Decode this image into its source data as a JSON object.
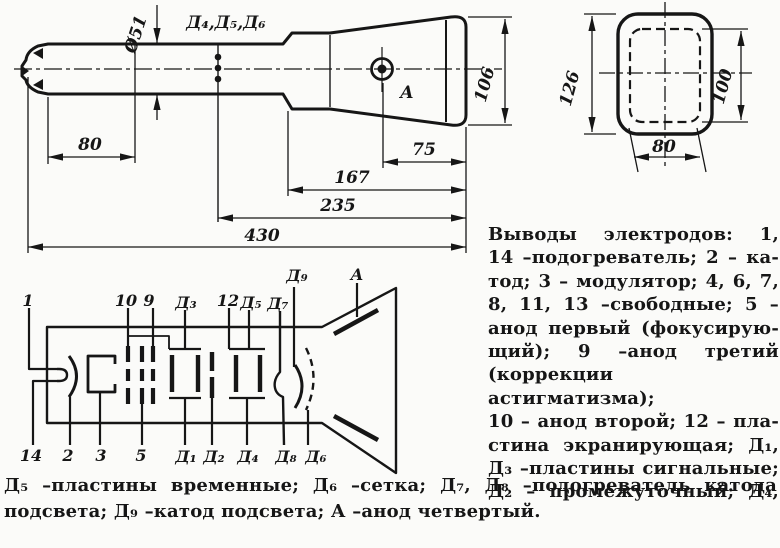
{
  "figure": {
    "side_view": {
      "dims": {
        "diameter": "Ø51",
        "d80": "80",
        "d75": "75",
        "d167": "167",
        "d235": "235",
        "d430": "430",
        "d106": "106"
      },
      "electrode_taps_label": "Д₄,Д₅,Д₆",
      "anode_label": "А"
    },
    "front_view": {
      "dims": {
        "d126": "126",
        "d100": "100",
        "d80": "80"
      }
    },
    "schematic": {
      "top_labels": {
        "p1": "1",
        "p10": "10",
        "p9": "9",
        "d3": "Д₃",
        "p12": "12",
        "d5": "Д₅",
        "d7": "Д₇",
        "d9": "Д₉",
        "anode": "А"
      },
      "bottom_labels": {
        "p14": "14",
        "p2": "2",
        "p3": "3",
        "p5": "5",
        "d1": "Д₁",
        "d2": "Д₂",
        "d4": "Д₄",
        "d8": "Д₈",
        "d6": "Д₆"
      }
    }
  },
  "caption": {
    "column_lines": [
      "Выводы электродов: 1,",
      "14 –подогреватель; 2 – ка-",
      "тод; 3 – модулятор; 4, 6, 7,",
      "8, 11, 13 –свободные; 5 –",
      "анод первый (фокусирую-",
      "щий); 9 –анод третий",
      "(коррекции астигматизма);",
      "10 – анод второй; 12 – пла-",
      "стина экранирующая; Д₁,",
      "Д₃ –пластины сигнальные;",
      "Д₂ – промежуточный; Д₄,"
    ],
    "bottom_lines": [
      "Д₅ –пластины временные; Д₆ –сетка; Д₇, Д₈ –подогреватель катода",
      "подсвета; Д₉ –катод подсвета; А –анод четвертый."
    ]
  }
}
